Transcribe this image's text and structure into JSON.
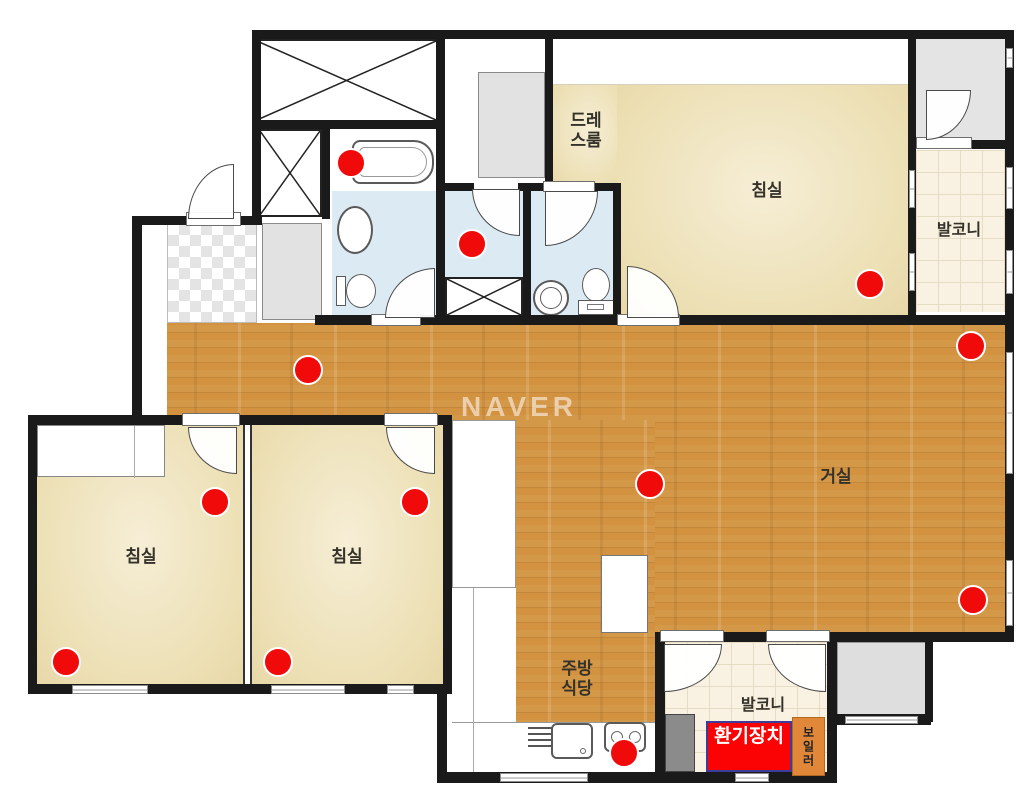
{
  "watermark": "NAVER",
  "labels": {
    "dressing_line1": "드레",
    "dressing_line2": "스룸",
    "bedroom": "침실",
    "balcony": "발코니",
    "living": "거실",
    "kitchen_line1": "주방",
    "kitchen_line2": "식당",
    "vent_line1": "환기",
    "vent_line2": "장치",
    "boiler": "보일러"
  },
  "colors": {
    "wall": "#1a1a1a",
    "wood_floor": "#d2923f",
    "bedroom_floor": "#ece0b8",
    "bathroom_floor": "#dcebf3",
    "balcony_tile": "#f9f1e1",
    "marker_red": "#f00a0a",
    "vent_bg": "#fb0204",
    "vent_border": "#3d3d99",
    "vent_text": "#ffffff",
    "boiler_bg": "#e0873a",
    "boiler_text": "#222222"
  },
  "markers": {
    "type": "red-dot",
    "count": 12,
    "points": [
      {
        "x": 351,
        "y": 163
      },
      {
        "x": 472,
        "y": 244
      },
      {
        "x": 308,
        "y": 370
      },
      {
        "x": 870,
        "y": 284
      },
      {
        "x": 971,
        "y": 346
      },
      {
        "x": 650,
        "y": 484
      },
      {
        "x": 973,
        "y": 600
      },
      {
        "x": 66,
        "y": 662
      },
      {
        "x": 215,
        "y": 502
      },
      {
        "x": 278,
        "y": 662
      },
      {
        "x": 415,
        "y": 502
      },
      {
        "x": 624,
        "y": 753
      }
    ]
  }
}
